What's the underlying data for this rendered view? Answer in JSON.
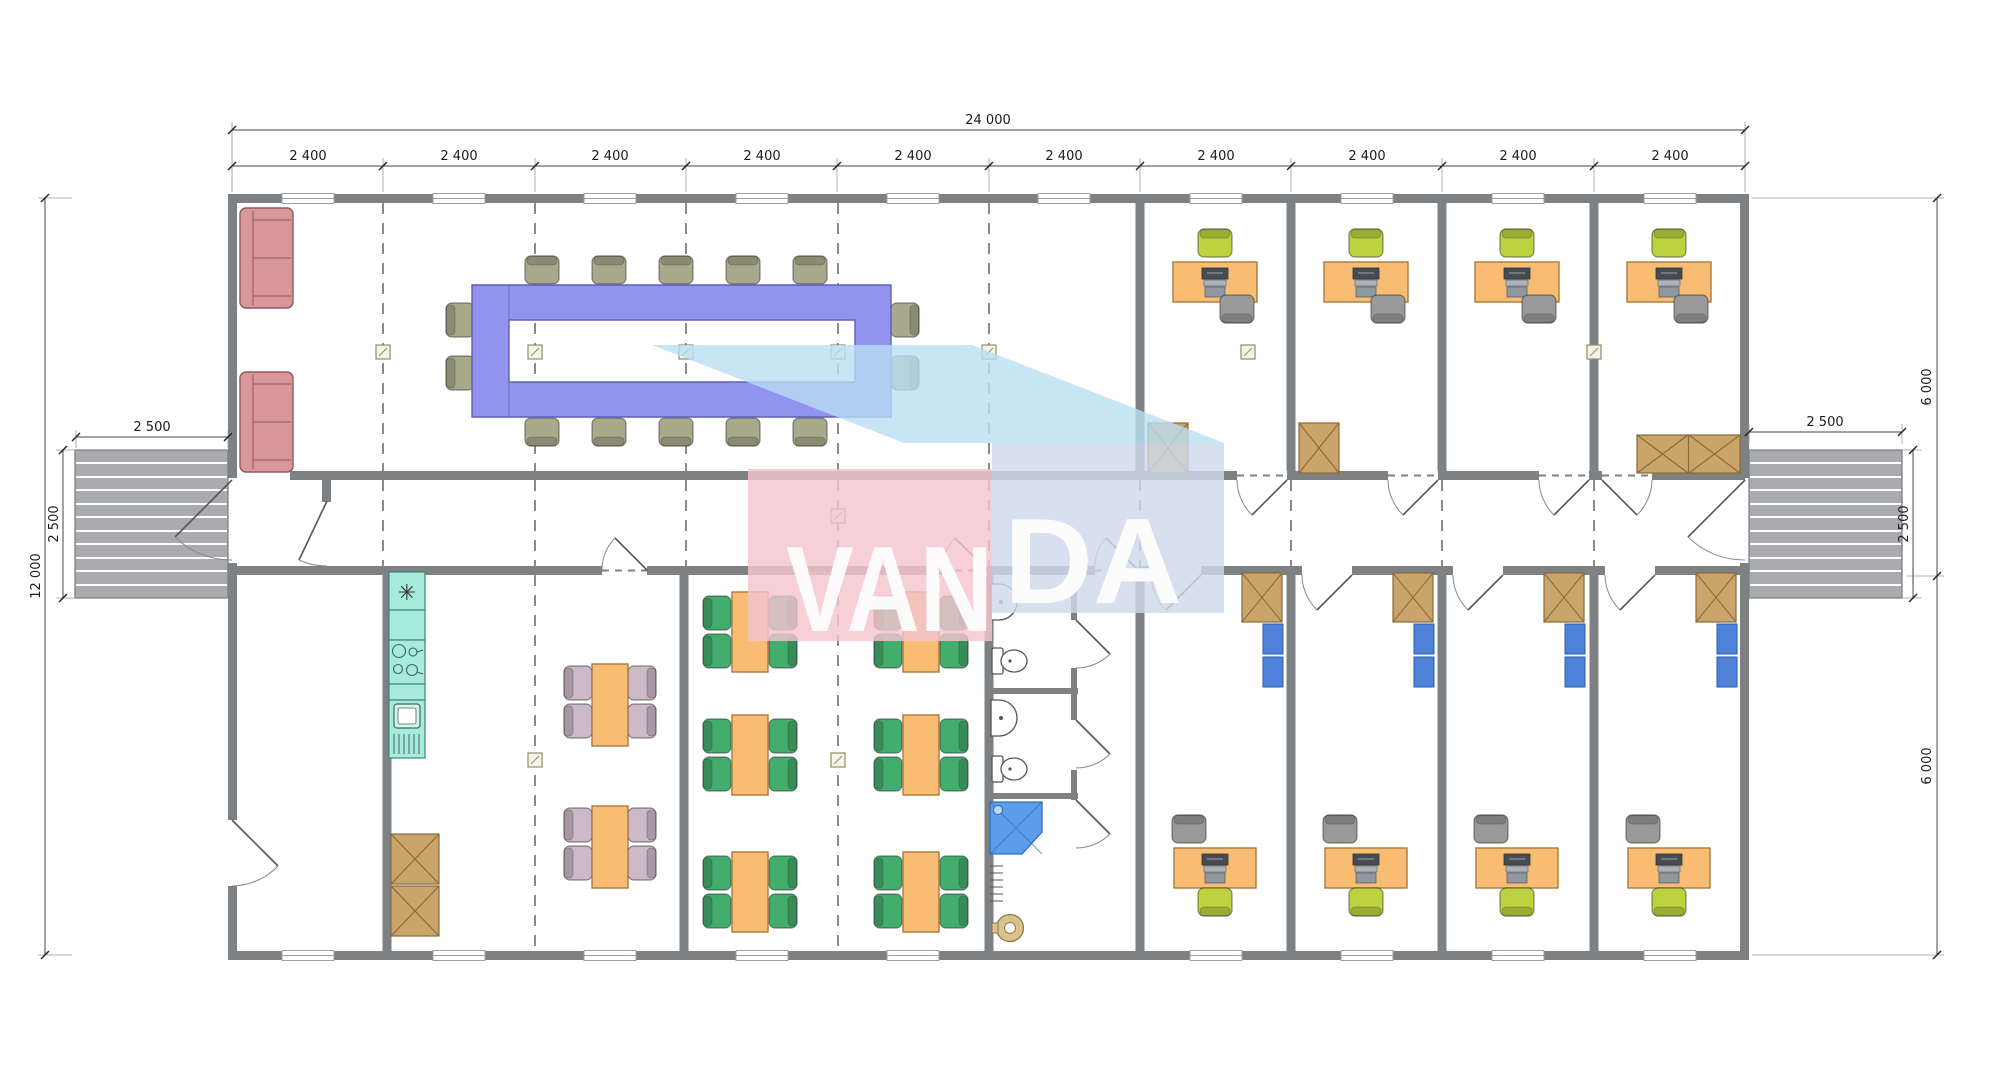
{
  "title": "Modular office building floor plan 24000 x 12000",
  "dims": {
    "overall": "24 000",
    "segments": [
      "2 400",
      "2 400",
      "2 400",
      "2 400",
      "2 400",
      "2 400",
      "2 400",
      "2 400",
      "2 400",
      "2 400"
    ],
    "left_total": "12 000",
    "left_ramp_width": "2 500",
    "left_ramp_depth": "2 500",
    "right_ramp_width": "2 500",
    "right_ramp_depth": "2 500",
    "right_top": "6 000",
    "right_bottom": "6 000"
  },
  "watermark": {
    "text": "VANDA",
    "part1": "VAN",
    "part2": "DA"
  },
  "kitchen": {
    "freezer_symbol": "✳"
  },
  "colors": {
    "wall": "#7e8184",
    "ramp": "#a9abae",
    "sofa": "#d9969b",
    "conf-table": "#9193ee",
    "chair-olive": "#a9aa8b",
    "chair-lime": "#bdd23f",
    "chair-gray": "#9a9a9a",
    "chair-green": "#42ad6c",
    "chair-mauve": "#ccbac9",
    "desk": "#f8bd72",
    "kitchen": "#a7ebdb",
    "wardrobe": "#caa56b",
    "shelf-blue": "#4d82d8",
    "shower": "#5d9ce8",
    "boiler": "#d9c28b",
    "wm-top": "#b9dff3",
    "wm-pink": "#f4c5ce",
    "wm-face": "#cdd9ea"
  }
}
